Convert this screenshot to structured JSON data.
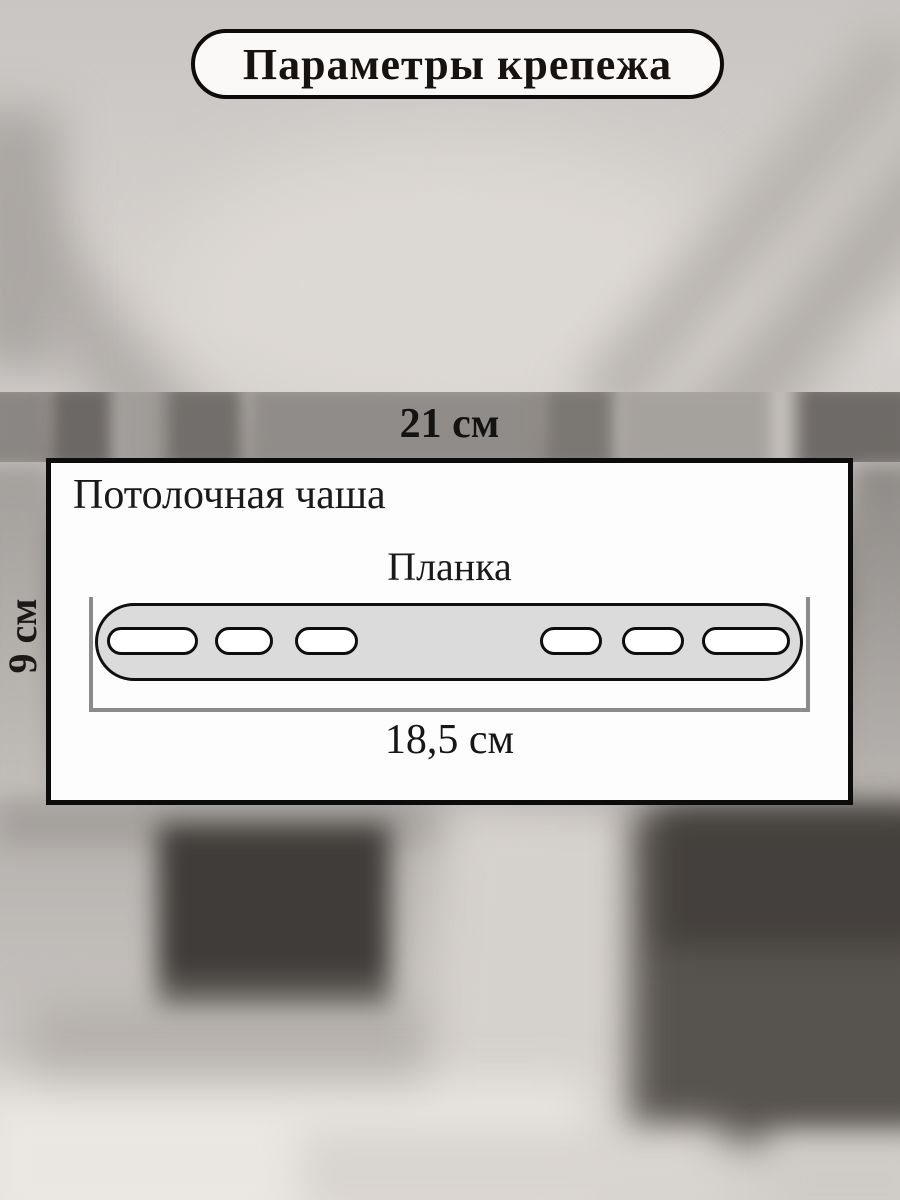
{
  "title": {
    "label": "Параметры крепежа"
  },
  "diagram": {
    "top_dimension": "21 см",
    "side_dimension": "9 см",
    "bottom_dimension": "18,5 см",
    "part_label_cup": "Потолочная чаша",
    "part_label_plank": "Планка",
    "slot_count": 6
  },
  "colors": {
    "box_fill": "#fdfdfd",
    "box_border": "#0c0c0c",
    "plank_fill": "#dbdbdb",
    "plank_border": "#101010",
    "dimension_line": "#8b8b8b",
    "pill_fill": "#faf9f7",
    "text": "#141210"
  }
}
